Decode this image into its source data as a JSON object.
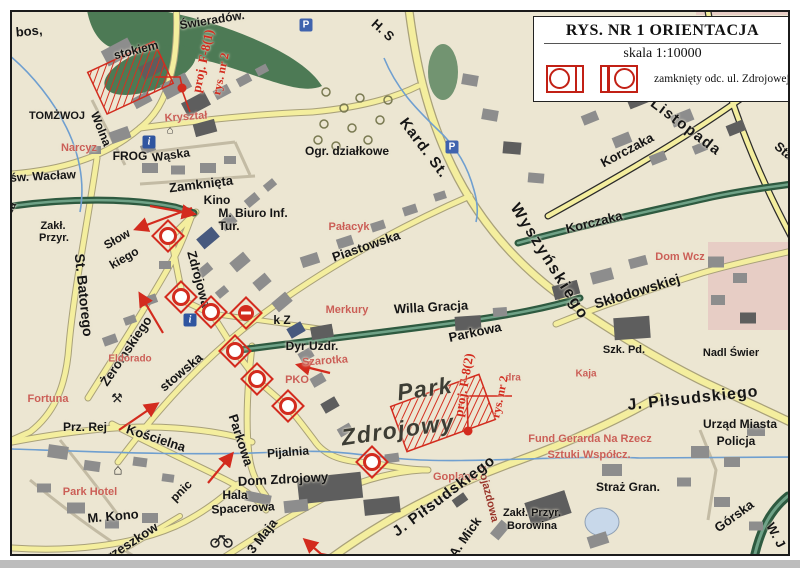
{
  "legend": {
    "title": "RYS. NR 1 ORIENTACJA",
    "scale": "skala 1:10000",
    "closed_section_label": "zamknięty odc. ul. Zdrojowej"
  },
  "colors": {
    "annotation_red": "#d32b1e",
    "poi_red": "#cb5f57",
    "road_yellow": "#f4ee9e",
    "green_road": "#3c6b51",
    "water": "#6f9fd0",
    "background": "#ece6d2"
  },
  "map_labels": [
    {
      "t": "bos,",
      "x": 29,
      "y": 31,
      "r": -5,
      "s": 13
    },
    {
      "t": "Świeradów.",
      "x": 212,
      "y": 20,
      "r": -9,
      "s": 12
    },
    {
      "t": "stokiem",
      "x": 136,
      "y": 50,
      "r": -14,
      "s": 12
    },
    {
      "t": "TOMŻWOJ",
      "x": 57,
      "y": 116,
      "r": 0,
      "s": 11
    },
    {
      "t": "Wolna",
      "x": 101,
      "y": 129,
      "r": 68,
      "s": 12
    },
    {
      "t": "Kryształ",
      "x": 186,
      "y": 117,
      "r": -4,
      "s": 11,
      "c": "poi"
    },
    {
      "t": "Narcyz",
      "x": 79,
      "y": 148,
      "r": 0,
      "s": 11,
      "c": "poi"
    },
    {
      "t": "FROG",
      "x": 130,
      "y": 156,
      "r": 0,
      "s": 12
    },
    {
      "t": "Wąska",
      "x": 171,
      "y": 155,
      "r": -8,
      "s": 12
    },
    {
      "t": "św. Wacław",
      "x": 43,
      "y": 176,
      "r": -3,
      "s": 12
    },
    {
      "t": "Zamknięta",
      "x": 201,
      "y": 184,
      "r": -7,
      "s": 13
    },
    {
      "t": "Kino",
      "x": 217,
      "y": 200,
      "r": 0,
      "s": 12
    },
    {
      "t": "M. Biuro Inf.",
      "x": 253,
      "y": 213,
      "r": 0,
      "s": 12
    },
    {
      "t": "Tur.",
      "x": 229,
      "y": 226,
      "r": 0,
      "s": 12
    },
    {
      "t": "icza",
      "x": 9,
      "y": 212,
      "r": -62,
      "s": 11
    },
    {
      "t": "Zakł.",
      "x": 53,
      "y": 226,
      "r": 0,
      "s": 11
    },
    {
      "t": "Przyr.",
      "x": 54,
      "y": 238,
      "r": 0,
      "s": 11
    },
    {
      "t": "St. Batorego",
      "x": 84,
      "y": 295,
      "r": 84,
      "s": 14
    },
    {
      "t": "Słow",
      "x": 117,
      "y": 239,
      "r": -30,
      "s": 12
    },
    {
      "t": "kiego",
      "x": 124,
      "y": 258,
      "r": -30,
      "s": 12
    },
    {
      "t": "Żeromskiego",
      "x": 126,
      "y": 351,
      "r": -56,
      "s": 13
    },
    {
      "t": "Zdrojowa",
      "x": 199,
      "y": 279,
      "r": 75,
      "s": 13
    },
    {
      "t": "stowska",
      "x": 181,
      "y": 372,
      "r": -40,
      "s": 13
    },
    {
      "t": "Eldorado",
      "x": 130,
      "y": 359,
      "r": 0,
      "s": 10,
      "c": "poi"
    },
    {
      "t": "H. S",
      "x": 383,
      "y": 30,
      "r": 42,
      "s": 13
    },
    {
      "t": "Ogr. działkowe",
      "x": 347,
      "y": 151,
      "r": 0,
      "s": 12
    },
    {
      "t": "Kard. St.",
      "x": 424,
      "y": 148,
      "r": 53,
      "s": 15,
      "ls": 1
    },
    {
      "t": "Wyszyńskiego",
      "x": 549,
      "y": 262,
      "r": 58,
      "s": 16,
      "ls": 2
    },
    {
      "t": "Piastowska",
      "x": 366,
      "y": 246,
      "r": -19,
      "s": 13
    },
    {
      "t": "Pałacyk",
      "x": 349,
      "y": 227,
      "r": 0,
      "s": 11,
      "c": "poi"
    },
    {
      "t": "Merkury",
      "x": 347,
      "y": 310,
      "r": 0,
      "s": 11,
      "c": "poi"
    },
    {
      "t": "Willa Gracja",
      "x": 431,
      "y": 307,
      "r": -3,
      "s": 13
    },
    {
      "t": "Parkowa",
      "x": 475,
      "y": 332,
      "r": -12,
      "s": 13
    },
    {
      "t": "Korczaka",
      "x": 627,
      "y": 150,
      "r": -28,
      "s": 13
    },
    {
      "t": "Korczaka",
      "x": 594,
      "y": 222,
      "r": -14,
      "s": 13
    },
    {
      "t": "Listopada",
      "x": 686,
      "y": 127,
      "r": 37,
      "s": 15,
      "ls": 1.5
    },
    {
      "t": "Staw",
      "x": 788,
      "y": 154,
      "r": 40,
      "s": 13
    },
    {
      "t": "Dom Wcz",
      "x": 680,
      "y": 257,
      "r": 0,
      "s": 11,
      "c": "poi"
    },
    {
      "t": "Skłodowskiej",
      "x": 637,
      "y": 291,
      "r": -17,
      "s": 14
    },
    {
      "t": "Szk. Pd.",
      "x": 624,
      "y": 350,
      "r": 0,
      "s": 11
    },
    {
      "t": "Nadl Świer",
      "x": 731,
      "y": 353,
      "r": 0,
      "s": 11
    },
    {
      "t": "Kaja",
      "x": 586,
      "y": 374,
      "r": 0,
      "s": 10,
      "c": "poi"
    },
    {
      "t": "J. Piłsudskiego",
      "x": 693,
      "y": 399,
      "r": -6,
      "s": 16,
      "ls": 1
    },
    {
      "t": "Urząd Miasta",
      "x": 740,
      "y": 424,
      "r": 0,
      "s": 12
    },
    {
      "t": "Policja",
      "x": 736,
      "y": 441,
      "r": 0,
      "s": 12
    },
    {
      "t": "Fund Gerarda Na Rzecz",
      "x": 590,
      "y": 439,
      "r": 0,
      "s": 11,
      "c": "poi"
    },
    {
      "t": "Sztuki Współcz.",
      "x": 589,
      "y": 455,
      "r": 0,
      "s": 11,
      "c": "poi"
    },
    {
      "t": "Straż Gran.",
      "x": 628,
      "y": 487,
      "r": 0,
      "s": 12
    },
    {
      "t": "Górska",
      "x": 734,
      "y": 516,
      "r": -36,
      "s": 13
    },
    {
      "t": "W. J",
      "x": 776,
      "y": 535,
      "r": 62,
      "s": 13
    },
    {
      "t": "Zakł. Przyr.",
      "x": 532,
      "y": 513,
      "r": 0,
      "s": 11
    },
    {
      "t": "Borowina",
      "x": 532,
      "y": 526,
      "r": 0,
      "s": 11
    },
    {
      "t": "k Z",
      "x": 282,
      "y": 320,
      "r": 0,
      "s": 12
    },
    {
      "t": "Dyr Uzdr.",
      "x": 312,
      "y": 346,
      "r": 0,
      "s": 12
    },
    {
      "t": "Szarotka",
      "x": 325,
      "y": 361,
      "r": -4,
      "s": 11,
      "c": "poi"
    },
    {
      "t": "PKO",
      "x": 297,
      "y": 380,
      "r": 0,
      "s": 11,
      "c": "poi"
    },
    {
      "t": "Park",
      "x": 425,
      "y": 389,
      "r": -8,
      "s": 23,
      "c": "park"
    },
    {
      "t": "Zdrojowy",
      "x": 398,
      "y": 430,
      "r": -8,
      "s": 23,
      "c": "park"
    },
    {
      "t": "dra",
      "x": 513,
      "y": 378,
      "r": 0,
      "s": 10,
      "c": "poi"
    },
    {
      "t": "Goplana",
      "x": 455,
      "y": 477,
      "r": 0,
      "s": 11,
      "c": "poi"
    },
    {
      "t": "Dojazdowa",
      "x": 488,
      "y": 494,
      "r": 76,
      "s": 11,
      "c": "poi2"
    },
    {
      "t": "J. Piłsudskiego",
      "x": 444,
      "y": 496,
      "r": -37,
      "s": 15,
      "ls": 1
    },
    {
      "t": "A. Mick",
      "x": 465,
      "y": 537,
      "r": -55,
      "s": 13
    },
    {
      "t": "Pijalnia",
      "x": 288,
      "y": 452,
      "r": -4,
      "s": 12
    },
    {
      "t": "Dom Zdrojowy",
      "x": 283,
      "y": 479,
      "r": -3,
      "s": 13
    },
    {
      "t": "Hala",
      "x": 235,
      "y": 495,
      "r": 0,
      "s": 12
    },
    {
      "t": "Spacerowa",
      "x": 243,
      "y": 508,
      "r": -3,
      "s": 12
    },
    {
      "t": "3 Maja",
      "x": 262,
      "y": 536,
      "r": -52,
      "s": 13
    },
    {
      "t": "Parkowa",
      "x": 241,
      "y": 440,
      "r": 72,
      "s": 13
    },
    {
      "t": "Kościelna",
      "x": 156,
      "y": 438,
      "r": 18,
      "s": 13
    },
    {
      "t": "Prz. Rej",
      "x": 85,
      "y": 427,
      "r": 0,
      "s": 12
    },
    {
      "t": "Fortuna",
      "x": 48,
      "y": 399,
      "r": 0,
      "s": 11,
      "c": "poi"
    },
    {
      "t": "Park Hotel",
      "x": 90,
      "y": 492,
      "r": 0,
      "s": 11,
      "c": "poi"
    },
    {
      "t": "M. Kono",
      "x": 113,
      "y": 516,
      "r": -5,
      "s": 13
    },
    {
      "t": "pnic",
      "x": 181,
      "y": 491,
      "r": -45,
      "s": 12
    },
    {
      "t": "Orzeszkow",
      "x": 128,
      "y": 544,
      "r": -33,
      "s": 13
    },
    {
      "t": "proj. F-8(1)",
      "x": 203,
      "y": 61,
      "r": -78,
      "s": 13,
      "c": "ann"
    },
    {
      "t": "rys. nr 2",
      "x": 221,
      "y": 74,
      "r": -78,
      "s": 12,
      "c": "ann"
    },
    {
      "t": "proj. F-8(2)",
      "x": 464,
      "y": 385,
      "r": -80,
      "s": 13,
      "c": "ann"
    },
    {
      "t": "rys. nr 2",
      "x": 500,
      "y": 397,
      "r": -78,
      "s": 12,
      "c": "ann"
    }
  ],
  "map_symbols": {
    "closed_road_markers": [
      [
        168,
        236
      ],
      [
        181,
        297
      ],
      [
        211,
        312
      ],
      [
        235,
        351
      ],
      [
        257,
        379
      ],
      [
        288,
        406
      ],
      [
        372,
        462
      ]
    ],
    "no_entry_markers": [
      [
        246,
        313
      ]
    ],
    "red_dots": [
      [
        182,
        88
      ],
      [
        468,
        431
      ]
    ],
    "parking_icons": [
      [
        306,
        25
      ],
      [
        452,
        147
      ]
    ],
    "parking_glyph": "P",
    "info_icons": [
      [
        149,
        142
      ],
      [
        190,
        320
      ]
    ],
    "info_glyph": "i",
    "poi_glyph_icons": [
      {
        "g": "⌂",
        "x": 118,
        "y": 470,
        "s": 15
      },
      {
        "g": "⚒",
        "x": 117,
        "y": 398,
        "s": 13
      },
      {
        "g": "⌂",
        "x": 170,
        "y": 131,
        "s": 11
      }
    ]
  }
}
